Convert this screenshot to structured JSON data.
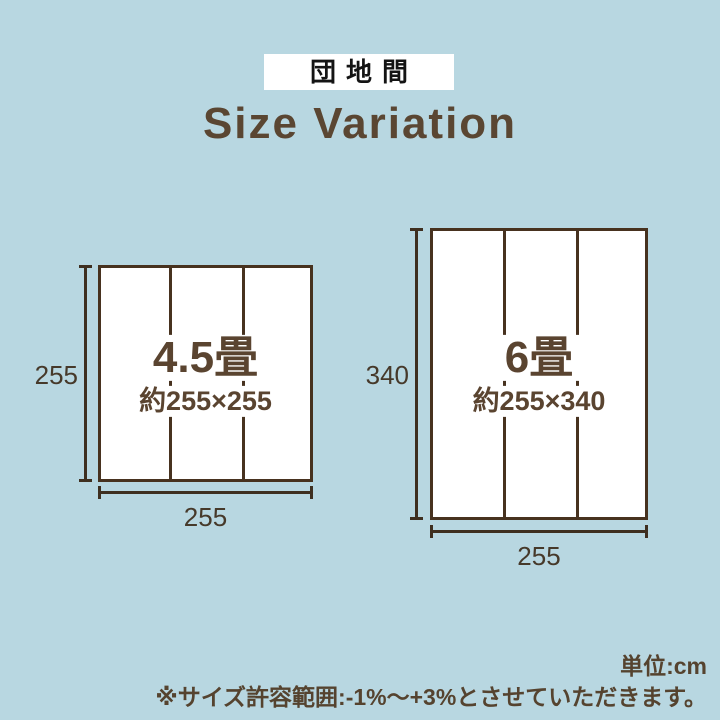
{
  "page": {
    "tag": "団地間",
    "title": "Size Variation",
    "unit_note": "単位:cm",
    "tolerance_note": "※サイズ許容範囲:-1%〜+3%とさせていただきます。"
  },
  "colors": {
    "background": "#b8d7e1",
    "box_fill": "#ffffff",
    "box_border": "#47321f",
    "dimension_line": "#3e2f20",
    "brown_text": "#5a4430",
    "note_text": "#55432f",
    "tag_bg": "#ffffff",
    "tag_text": "#141414"
  },
  "figures": [
    {
      "id": "4.5jo",
      "tatami_label": "4.5畳",
      "size_label": "約255×255",
      "height_dim": "255",
      "width_dim": "255",
      "panels": 3
    },
    {
      "id": "6jo",
      "tatami_label": "6畳",
      "size_label": "約255×340",
      "height_dim": "340",
      "width_dim": "255",
      "panels": 3
    }
  ]
}
